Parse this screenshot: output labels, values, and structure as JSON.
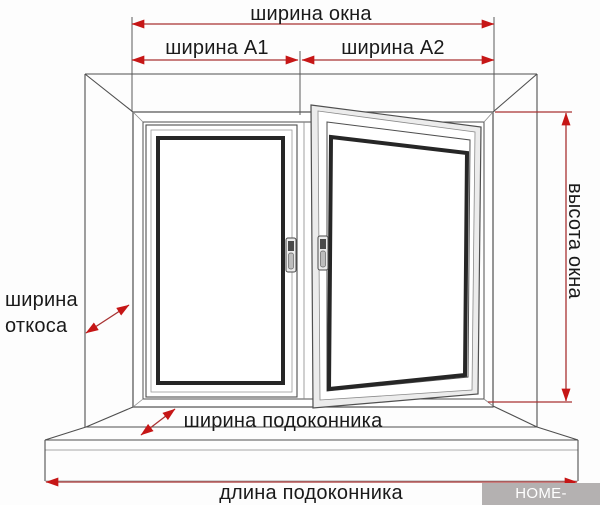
{
  "diagram": {
    "subject": "window measurement scheme",
    "labels": {
      "window_width": "ширина окна",
      "width_a1": "ширина А1",
      "width_a2": "ширина А2",
      "window_height": "высота окна",
      "slope_width": "ширина откоса",
      "sill_width": "ширина подоконника",
      "sill_length": "длина подоконника"
    }
  },
  "watermark": {
    "text": "HOME-IDEAS.RU"
  },
  "colors": {
    "dimension_line_red": "#a83232",
    "arrowhead_red": "#c61616",
    "drawing_line": "#4f4f4f",
    "glass_gasket": "#262626",
    "label_text": "#1a1a1a",
    "watermark_bg": "#b4b1b1",
    "watermark_text": "#ffffff"
  }
}
